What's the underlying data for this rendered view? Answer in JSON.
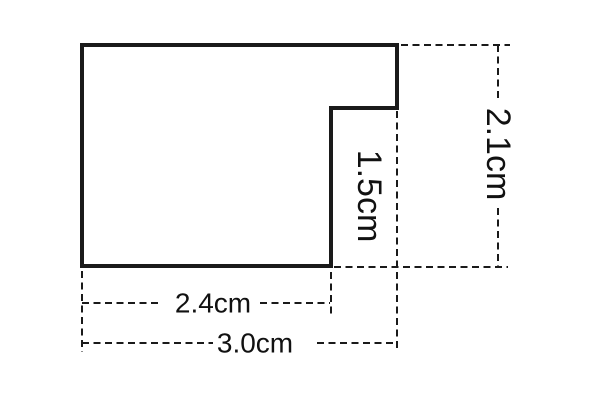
{
  "figure": {
    "description": "rectangle-with-step-notch cross-section",
    "background_color": "#ffffff",
    "line_color": "#1a1a1a",
    "text_color": "#111111",
    "dimensions": {
      "bottom_width": "2.4cm",
      "total_width": "3.0cm",
      "notch_height": "1.5cm",
      "total_height": "2.1cm"
    }
  }
}
